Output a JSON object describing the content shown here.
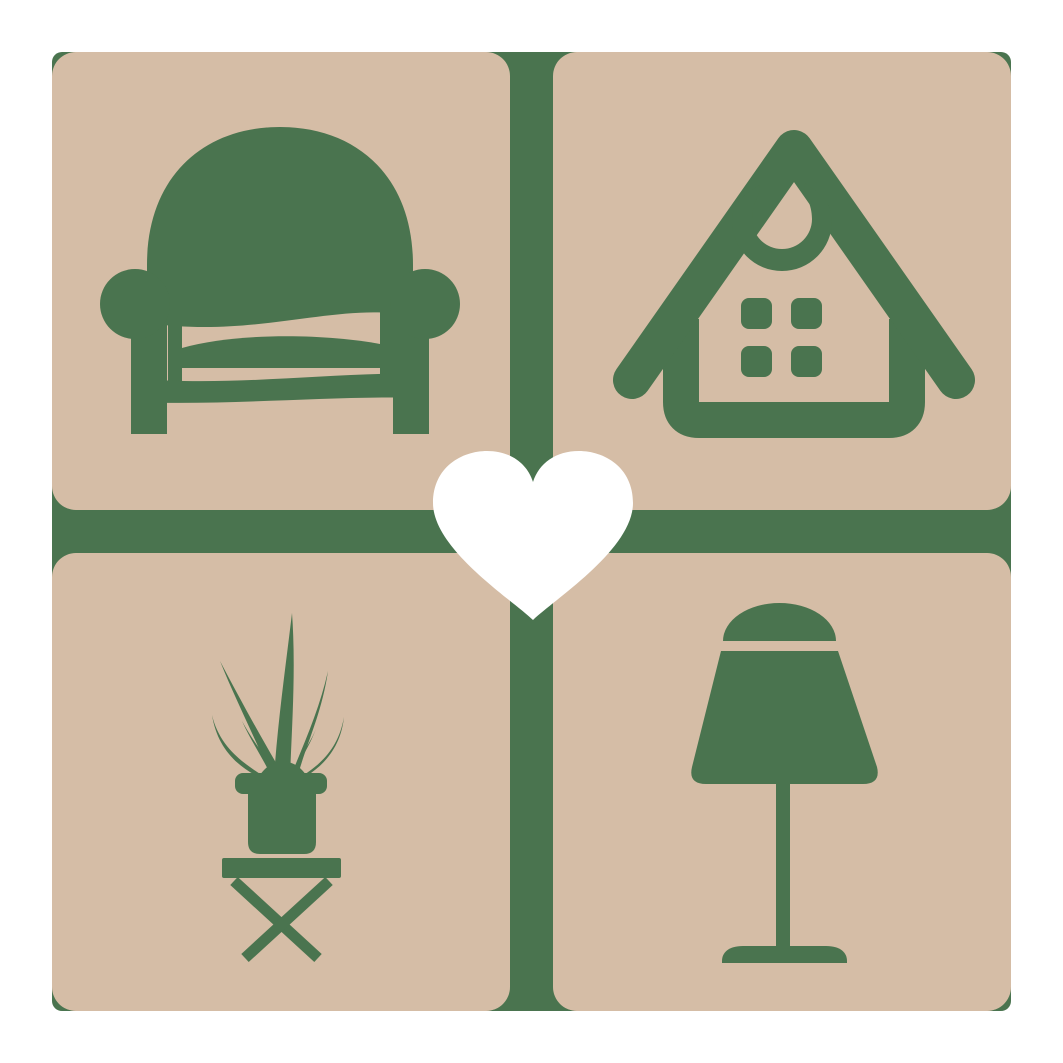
{
  "logo": {
    "name": "home-furniture-heart-logo",
    "aria_label": "Logo: four tan rounded squares with green icons of an armchair, a house, a potted plant and a table lamp, separated by a green cross with a white heart in the center",
    "colors": {
      "page": "#ffffff",
      "tile": "#d5bda6",
      "icon-green": "#4a744f",
      "heart": "#ffffff"
    },
    "tiles": [
      {
        "position": "top-left",
        "icon": "armchair-icon",
        "label": "armchair"
      },
      {
        "position": "top-right",
        "icon": "house-icon",
        "label": "house"
      },
      {
        "position": "bottom-left",
        "icon": "potted-plant-icon",
        "label": "potted plant on stool"
      },
      {
        "position": "bottom-right",
        "icon": "table-lamp-icon",
        "label": "table lamp"
      }
    ],
    "center_icon": "heart-icon"
  }
}
